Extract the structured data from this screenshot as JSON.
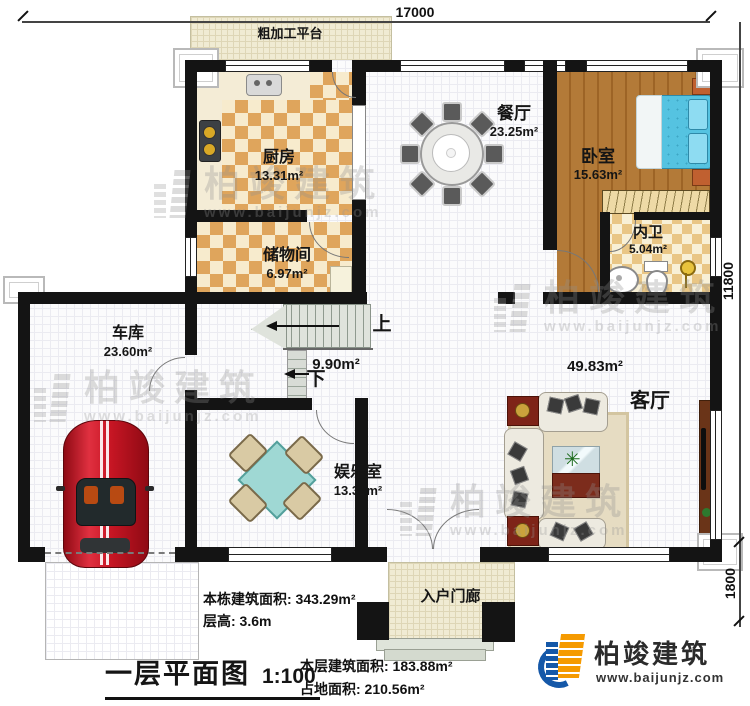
{
  "plan": {
    "dimensions": {
      "width_top": "17000",
      "height_right": "11800",
      "porch_right": "1800"
    },
    "rooms": {
      "platform": {
        "label": "粗加工平台"
      },
      "kitchen": {
        "label": "厨房",
        "area": "13.31m²"
      },
      "storage": {
        "label": "储物间",
        "area": "6.97m²"
      },
      "dining": {
        "label": "餐厅",
        "area": "23.25m²"
      },
      "bedroom": {
        "label": "卧室",
        "area": "15.63m²"
      },
      "bathroom": {
        "label": "内卫",
        "area": "5.04m²"
      },
      "garage": {
        "label": "车库",
        "area": "23.60m²"
      },
      "entertainment": {
        "label": "娱乐室",
        "area": "13.31m²"
      },
      "living": {
        "label": "客厅",
        "area": "49.83m²"
      },
      "hall": {
        "area": "9.90m²",
        "up": "上",
        "down": "下"
      },
      "porch": {
        "label": "入户门廊"
      }
    }
  },
  "footer": {
    "building_area": "本栋建筑面积: 343.29m²",
    "floor_height": "层高: 3.6m",
    "plan_title": "一层平面图",
    "plan_scale": "1:100",
    "floor_area": "本层建筑面积: 183.88m²",
    "land_area": "占地面积: 210.56m²"
  },
  "brand": {
    "name": "柏竣建筑",
    "website": "www.baijunjz.com"
  },
  "watermark": {
    "name": "柏竣建筑",
    "website": "www.baijunjz.com"
  },
  "colors": {
    "wall": "#141414",
    "checker_dark": "#dfa55c",
    "checker_light": "#f7ebcd",
    "wood": "#b37a38",
    "bed_blue": "#55c3e1",
    "car_red": "#c81624",
    "brand_blue": "#1558a8",
    "brand_orange": "#f59a00"
  }
}
